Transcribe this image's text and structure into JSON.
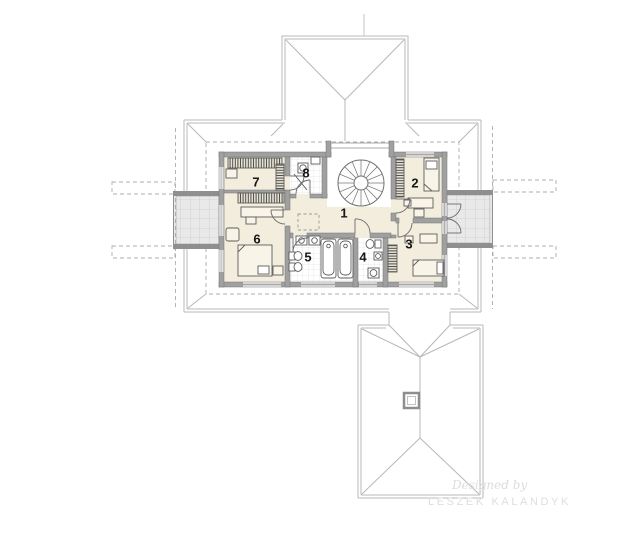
{
  "plan": {
    "title": "attic floor plan",
    "rooms": [
      {
        "number": "1"
      },
      {
        "number": "2"
      },
      {
        "number": "3"
      },
      {
        "number": "4"
      },
      {
        "number": "5"
      },
      {
        "number": "6"
      },
      {
        "number": "7"
      },
      {
        "number": "8"
      }
    ]
  },
  "watermark": {
    "line1": "Designed by",
    "line2": "LESZEK KALANDYK"
  },
  "colors": {
    "wall": "#a0a0a0",
    "floor": "#f3eddd",
    "roof_line": "#b8b8b8",
    "balcony_tile": "#e9e9e9",
    "bath_tile": "#ffffff",
    "dashed_line": "#acacac"
  }
}
